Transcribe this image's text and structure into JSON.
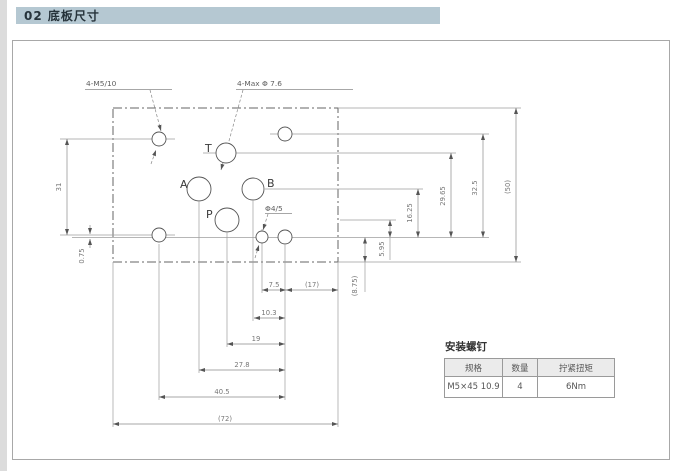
{
  "page": {
    "section_title": "02 底板尺寸"
  },
  "drawing": {
    "callouts": {
      "mounting_thread": "4-M5/10",
      "port_max_dia": "4-Max Φ 7.6",
      "small_hole": "Φ4/5"
    },
    "ports": {
      "t": "T",
      "a": "A",
      "b": "B",
      "p": "P"
    },
    "dimensions": {
      "v31": "31",
      "v075": "0.75",
      "v1625": "16.25",
      "v2965": "29.65",
      "v325": "32.5",
      "v50": "(50)",
      "v595": "5.95",
      "v875": "(8.75)",
      "h75": "7.5",
      "h17": "(17)",
      "h103": "10.3",
      "h19": "19",
      "h278": "27.8",
      "h405": "40.5",
      "h72": "(72)"
    }
  },
  "table": {
    "title": "安装螺钉",
    "headers": [
      "规格",
      "数量",
      "拧紧扭矩"
    ],
    "rows": [
      [
        "M5×45 10.9",
        "4",
        "6Nm"
      ]
    ]
  },
  "colors": {
    "section_bar_bg": "#b5c8d2",
    "frame_border": "#a8a8a8",
    "line": "#9a9a9a",
    "outline": "#666666",
    "dim_text": "#777777"
  }
}
